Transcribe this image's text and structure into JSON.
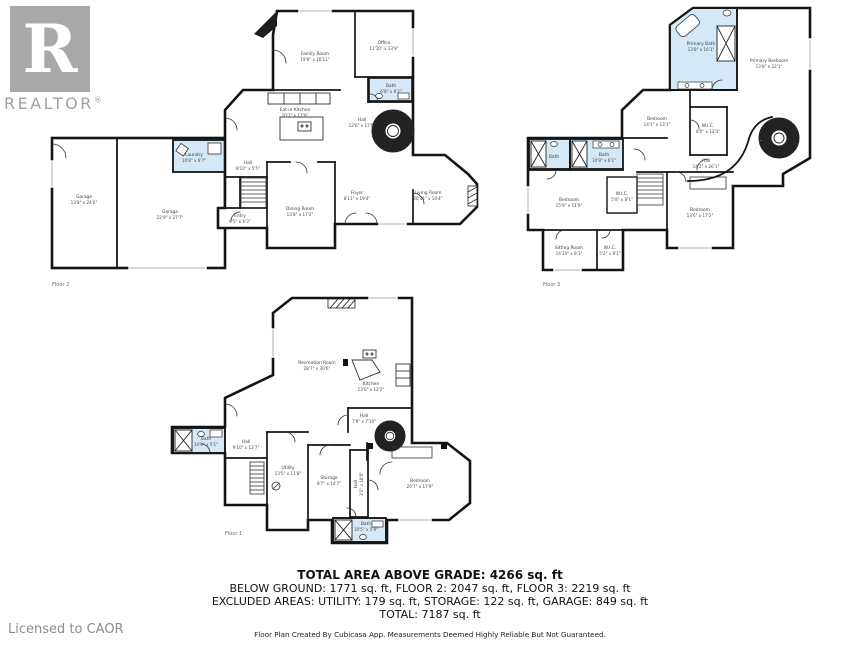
{
  "branding": {
    "logo_r": "R",
    "logo_text": "REALTOR",
    "registered_mark": "®",
    "license_text": "Licensed to CAOR"
  },
  "colors": {
    "wall": "#141414",
    "bath_fill": "#d4e8f6",
    "logo_gray": "#a8a8a8",
    "license_gray": "#8c8c8c"
  },
  "summary": {
    "title": "TOTAL AREA ABOVE GRADE: 4266 sq. ft",
    "line2": "BELOW GROUND: 1771 sq. ft, FLOOR 2: 2047 sq. ft, FLOOR 3: 2219 sq. ft",
    "line3": "EXCLUDED AREAS: UTILITY: 179 sq. ft, STORAGE: 122 sq. ft, GARAGE: 849 sq. ft",
    "line4": "TOTAL: 7187 sq. ft",
    "disclaimer": "Floor Plan Created By Cubicasa App. Measurements Deemed Highly Reliable But Not Guaranteed."
  },
  "floor2": {
    "floor_label": "Floor 2",
    "rooms": {
      "garage_a": {
        "name": "Garage",
        "dims": "13'8\" x 24'6\""
      },
      "garage_b": {
        "name": "Garage",
        "dims": "22'9\" x 27'7\""
      },
      "laundry": {
        "name": "Laundry",
        "dims": "10'8\" x 6'7\""
      },
      "hall_a": {
        "name": "Hall",
        "dims": "8'10\" x 5'5\""
      },
      "entry": {
        "name": "Entry",
        "dims": "6'5\" x 6'3\""
      },
      "family": {
        "name": "Family Room",
        "dims": "19'6\" x 16'11\""
      },
      "office": {
        "name": "Office",
        "dims": "11'10\" x 13'9\""
      },
      "bath": {
        "name": "Bath",
        "dims": "6'8\" x 8'2\""
      },
      "kitchen": {
        "name": "Eat-in Kitchen",
        "dims": "20'1\" x 17'9\""
      },
      "hall_b": {
        "name": "Hall",
        "dims": "12'6\" x 17'6\""
      },
      "foyer": {
        "name": "Foyer",
        "dims": "8'11\" x 19'4\""
      },
      "living": {
        "name": "Living Room",
        "dims": "20'11\" x 14'4\""
      },
      "dining": {
        "name": "Dining Room",
        "dims": "13'8\" x 17'2\""
      }
    }
  },
  "floor3": {
    "floor_label": "Floor 3",
    "rooms": {
      "primary_bath": {
        "name": "Primary Bath",
        "dims": "13'8\" x 16'1\""
      },
      "primary_bedroom": {
        "name": "Primary Bedroom",
        "dims": "13'8\" x 22'1\""
      },
      "bedroom_a": {
        "name": "Bedroom",
        "dims": "14'1\" x 13'1\""
      },
      "wic_a": {
        "name": "W.I.C.",
        "dims": "8'0\" x 13'4\""
      },
      "bath_a": {
        "name": "Bath",
        "dims": ""
      },
      "bath_b": {
        "name": "Bath",
        "dims": "10'9\" x 6'1\""
      },
      "bedroom_b": {
        "name": "Bedroom",
        "dims": "15'9\" x 11'9\""
      },
      "wic_b": {
        "name": "W.I.C.",
        "dims": "5'8\" x 8'1\""
      },
      "hall": {
        "name": "Hall",
        "dims": "14'2\" x 26'1\""
      },
      "bedroom_c": {
        "name": "Bedroom",
        "dims": "13'6\" x 17'2\""
      },
      "sitting": {
        "name": "Sitting Room",
        "dims": "14'10\" x 8'1\""
      },
      "wic_c": {
        "name": "W.I.C.",
        "dims": "5'2\" x 8'1\""
      }
    }
  },
  "floor1": {
    "floor_label": "Floor 1",
    "rooms": {
      "recreation": {
        "name": "Recreation Room",
        "dims": "28'7\" x 30'6\""
      },
      "kitchen": {
        "name": "Kitchen",
        "dims": "13'0\" x 12'2\""
      },
      "hall_a": {
        "name": "Hall",
        "dims": "7'9\" x 7'10\""
      },
      "bath_a": {
        "name": "Bath",
        "dims": "10'8\" x 5'1\""
      },
      "hall_b": {
        "name": "Hall",
        "dims": "9'10\" x 12'7\""
      },
      "utility": {
        "name": "Utility",
        "dims": "13'5\" x 11'8\""
      },
      "storage": {
        "name": "Storage",
        "dims": "8'7\" x 14'7\""
      },
      "hall_c": {
        "name": "Hall",
        "dims": "3'1\" x 10'0\""
      },
      "bedroom": {
        "name": "Bedroom",
        "dims": "20'7\" x 17'9\""
      },
      "bath_b": {
        "name": "Bath",
        "dims": "10'5\" x 5'9\""
      }
    }
  }
}
